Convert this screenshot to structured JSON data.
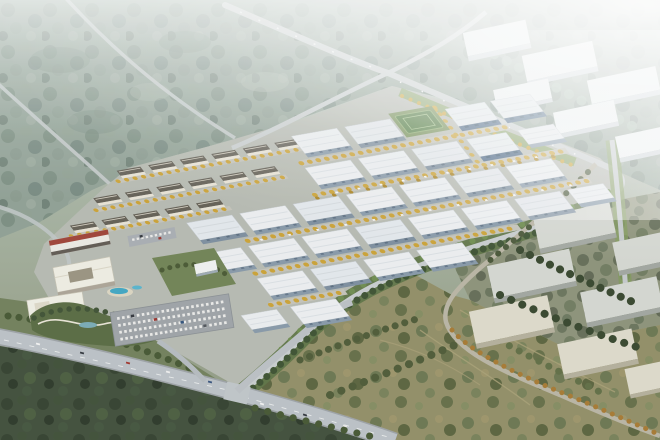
{
  "meta": {
    "title": "Aerial rendering of a master-planned logistics and industrial park",
    "description": "Bird's-eye architectural rendering: a dense grid of white flat-roofed warehouses with yellow-tree-lined streets, a cluster of cream apartment rows, an office and hotel campus with pools, a curving landscaped park and full parking lot at the west edge. Hazy forest and a highway interchange lie to the north, existing big-box industrial halls to the east fade into fog, warm olive scrubland with a diagonal tree-lined road spreads to the south-east, and a wide arterial road with traffic and dark forest crosses the south-west corner.",
    "type": "architectural-rendering",
    "view": "aerial-oblique",
    "atmosphere": "hazy-daylight",
    "width_px": 660,
    "height_px": 440
  },
  "palette": {
    "haze": "#f2f5f4",
    "forest_far": "#8d9e92",
    "forest_dark": "#3d4b37",
    "scrub": "#8f8c64",
    "site_ground": "#b4b8af",
    "road": "#c6cbcc",
    "arterial": "#b9bfc4",
    "warehouse_roof": "#eaedef",
    "warehouse_wall": "#8496a6",
    "blue_wall": "#3f5d7d",
    "tree_yellow": "#c9a032",
    "tree_green": "#394f2e",
    "green_belt": "#5b7142",
    "apartment_wall": "#e6e1d3",
    "apartment_roof": "#605c52",
    "red_roof": "#9c4034",
    "pool": "#3da4c0",
    "parking": "#9ba1a5",
    "hall_roof": "#d2d5cf",
    "beige_roof": "#dcd9c9",
    "hazy_roof": "#edf1f2",
    "field_green": "#4a7539",
    "lawn": "#7e9a58"
  },
  "scene": {
    "regions": [
      {
        "name": "distant-forest-northwest",
        "description": "Hazy blue-green forest crossed by two parallel distant roads",
        "base_color": "#8d9e92"
      },
      {
        "name": "highway-interchange-north",
        "description": "Highway descending to a four-way crossing, then wrapping the park's north-east edge",
        "color": "#c6cbcc"
      },
      {
        "name": "hazy-industrial-northeast",
        "description": "Existing big-box warehouses among trees fading into white fog",
        "building_count": 6
      },
      {
        "name": "warehouse-grid",
        "description": "New park: six staggered rows of white ridge-roof warehouses, three with blue walls, streets lined with yellow autumn trees",
        "building_count": 30,
        "blue_walled_count": 3
      },
      {
        "name": "residential-cluster",
        "description": "Three staggered rows of cream mid-rise apartment blocks with grey roofs",
        "building_count": 17
      },
      {
        "name": "amenity-campus",
        "description": "Commercial hall with red roof band, white office block with courtyard, hotel with two blue pools, curving landscaped park with ponds, and parking lots full of cars"
      },
      {
        "name": "sports-field",
        "description": "Small green pitch among the northern warehouses"
      },
      {
        "name": "east-industrial",
        "description": "Existing grey and beige industrial halls east of the boundary road, separated by dark tree rows",
        "building_count": 7
      },
      {
        "name": "southeast-scrub",
        "description": "Warm olive scrubland with sage tree clusters, faint trails and a diagonal road lined with orange trees"
      },
      {
        "name": "south-forest",
        "description": "Dark green forest below the arterial road"
      },
      {
        "name": "arterial-south",
        "description": "Wide light-grey arterial with lane dashes, an intersection and colored car traffic"
      }
    ],
    "vehicles": {
      "road_cars": 12,
      "parking_rows": 5,
      "parked_cars_approx": 40
    }
  }
}
